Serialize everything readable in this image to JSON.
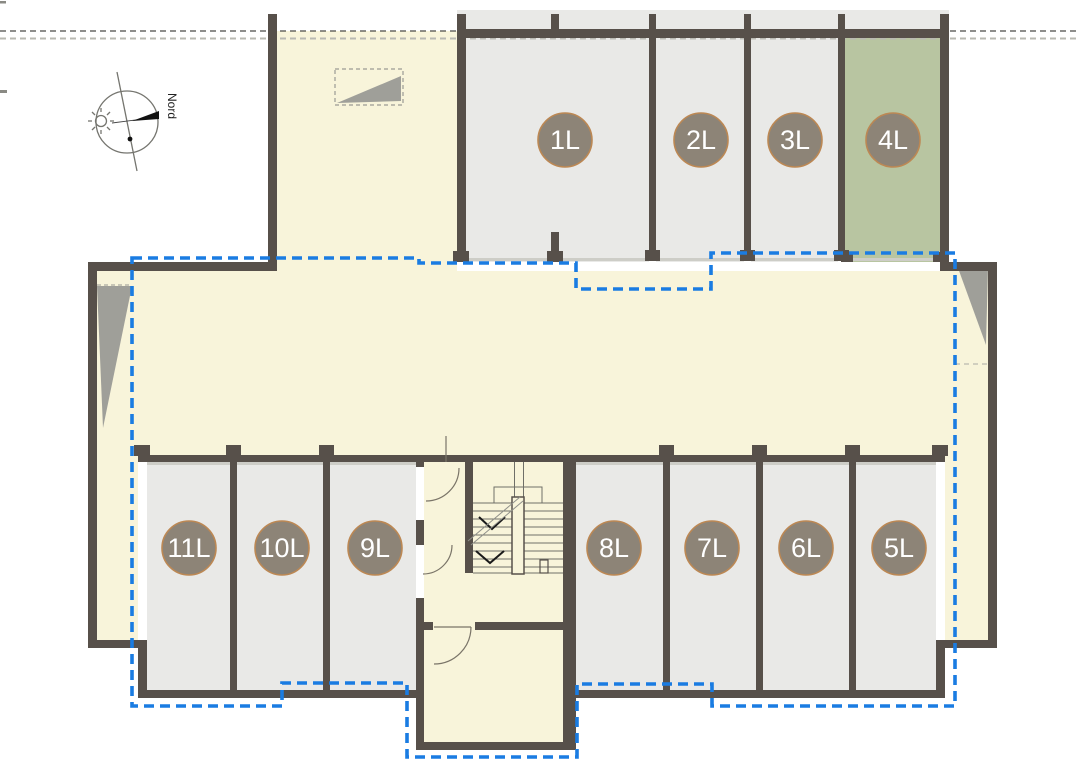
{
  "page": {
    "type": "architectural-floor-plan"
  },
  "compass": {
    "label": "Nord"
  },
  "units": {
    "top": [
      {
        "label": "1L",
        "highlighted": false
      },
      {
        "label": "2L",
        "highlighted": false
      },
      {
        "label": "3L",
        "highlighted": false
      },
      {
        "label": "4L",
        "highlighted": true
      }
    ],
    "bottom": [
      {
        "label": "11L",
        "highlighted": false
      },
      {
        "label": "10L",
        "highlighted": false
      },
      {
        "label": "9L",
        "highlighted": false
      },
      {
        "label": "8L",
        "highlighted": false
      },
      {
        "label": "7L",
        "highlighted": false
      },
      {
        "label": "6L",
        "highlighted": false
      },
      {
        "label": "5L",
        "highlighted": false
      }
    ]
  },
  "selection": {
    "highlighted_unit": "4L",
    "boundary_color": "#1a7ce2"
  },
  "colors": {
    "wall": "#57504a",
    "floor_cream": "#f8f4da",
    "unit_gray": "#e9e9e7",
    "unit_highlight_green": "#b8c5a1",
    "badge_fill": "#8d8477",
    "badge_border": "#bc8854",
    "boundary_blue": "#1a7ce2"
  }
}
